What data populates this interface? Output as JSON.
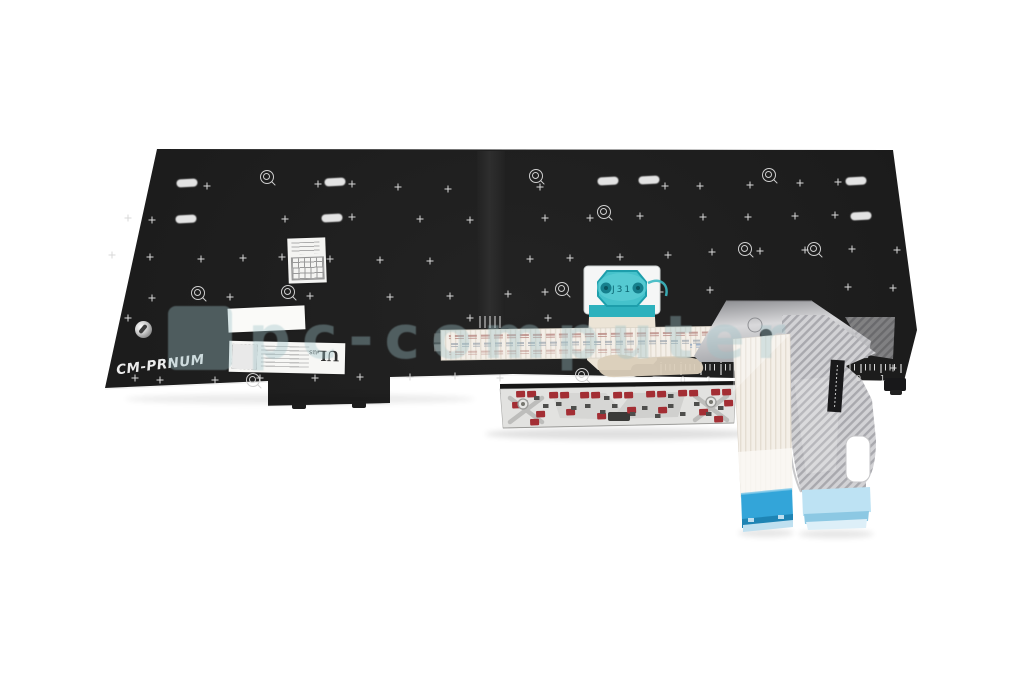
{
  "photo": {
    "subject": "laptop-keyboard-replacement-backside",
    "background": "white"
  },
  "plate": {
    "part_label": "CM-PRNUM",
    "trackpoint_marking": "J31",
    "ruler_left": [
      "0",
      "1"
    ],
    "ruler_right": [
      "0",
      "1"
    ]
  },
  "label": {
    "ul_mark": "UL",
    "ul_suffix": "us"
  },
  "watermark": {
    "text": "pc-computer"
  },
  "colors": {
    "plate": "#1c1c1c",
    "teal": "#45c2cb",
    "teal_dark": "#1d9eab",
    "ribbon": "#f4efe8",
    "cable_blue": "#33a5d9",
    "cable_blue_light": "#bde2f3",
    "red_pad": "#a32e34",
    "watermark": "rgba(158,194,199,0.38)"
  },
  "decorations": {
    "plus_marks": [
      [
        207,
        186
      ],
      [
        318,
        184
      ],
      [
        352,
        184
      ],
      [
        398,
        187
      ],
      [
        448,
        189
      ],
      [
        540,
        187
      ],
      [
        665,
        186
      ],
      [
        700,
        186
      ],
      [
        750,
        185
      ],
      [
        800,
        183
      ],
      [
        838,
        182
      ],
      [
        128,
        218
      ],
      [
        152,
        220
      ],
      [
        285,
        219
      ],
      [
        352,
        217
      ],
      [
        420,
        219
      ],
      [
        470,
        220
      ],
      [
        545,
        218
      ],
      [
        590,
        218
      ],
      [
        640,
        216
      ],
      [
        703,
        217
      ],
      [
        748,
        217
      ],
      [
        795,
        216
      ],
      [
        835,
        215
      ],
      [
        112,
        255
      ],
      [
        150,
        257
      ],
      [
        201,
        259
      ],
      [
        243,
        258
      ],
      [
        282,
        257
      ],
      [
        330,
        259
      ],
      [
        380,
        260
      ],
      [
        430,
        261
      ],
      [
        530,
        259
      ],
      [
        570,
        258
      ],
      [
        620,
        257
      ],
      [
        668,
        255
      ],
      [
        712,
        252
      ],
      [
        760,
        251
      ],
      [
        805,
        250
      ],
      [
        852,
        249
      ],
      [
        897,
        250
      ],
      [
        152,
        298
      ],
      [
        230,
        297
      ],
      [
        310,
        296
      ],
      [
        390,
        297
      ],
      [
        450,
        296
      ],
      [
        508,
        294
      ],
      [
        545,
        292
      ],
      [
        610,
        293
      ],
      [
        660,
        292
      ],
      [
        710,
        290
      ],
      [
        848,
        287
      ],
      [
        893,
        288
      ],
      [
        128,
        318
      ],
      [
        470,
        318
      ],
      [
        548,
        318
      ],
      [
        135,
        378
      ],
      [
        160,
        380
      ],
      [
        215,
        380
      ],
      [
        260,
        378
      ],
      [
        315,
        378
      ],
      [
        360,
        377
      ],
      [
        410,
        377
      ],
      [
        455,
        376
      ],
      [
        500,
        378
      ],
      [
        893,
        368
      ]
    ],
    "ovals": [
      [
        187,
        183
      ],
      [
        335,
        182
      ],
      [
        608,
        181
      ],
      [
        649,
        180
      ],
      [
        856,
        181
      ],
      [
        186,
        219
      ],
      [
        332,
        218
      ],
      [
        861,
        216
      ]
    ],
    "screws": [
      [
        267,
        177
      ],
      [
        536,
        176
      ],
      [
        604,
        212
      ],
      [
        769,
        175
      ],
      [
        198,
        293
      ],
      [
        288,
        292
      ],
      [
        562,
        289
      ],
      [
        745,
        249
      ],
      [
        814,
        249
      ],
      [
        253,
        380
      ],
      [
        582,
        375
      ]
    ],
    "red_pads": [
      [
        516,
        391
      ],
      [
        527,
        391
      ],
      [
        549,
        392
      ],
      [
        560,
        392
      ],
      [
        580,
        392
      ],
      [
        591,
        392
      ],
      [
        613,
        392
      ],
      [
        624,
        392
      ],
      [
        646,
        391
      ],
      [
        657,
        391
      ],
      [
        678,
        390
      ],
      [
        689,
        390
      ],
      [
        711,
        389
      ],
      [
        722,
        389
      ],
      [
        536,
        411
      ],
      [
        566,
        409
      ],
      [
        597,
        413
      ],
      [
        627,
        407
      ],
      [
        658,
        407
      ],
      [
        699,
        409
      ],
      [
        530,
        419
      ],
      [
        714,
        416
      ],
      [
        512,
        402
      ],
      [
        724,
        400
      ]
    ],
    "gray_bits": [
      [
        522,
        400
      ],
      [
        543,
        404
      ],
      [
        556,
        402
      ],
      [
        571,
        406
      ],
      [
        585,
        404
      ],
      [
        600,
        410
      ],
      [
        612,
        404
      ],
      [
        630,
        412
      ],
      [
        642,
        406
      ],
      [
        655,
        414
      ],
      [
        668,
        404
      ],
      [
        680,
        412
      ],
      [
        694,
        402
      ],
      [
        706,
        412
      ],
      [
        718,
        406
      ],
      [
        534,
        396
      ],
      [
        604,
        396
      ],
      [
        668,
        394
      ]
    ],
    "metal_rings": [
      [
        523,
        404
      ],
      [
        711,
        402
      ]
    ]
  }
}
